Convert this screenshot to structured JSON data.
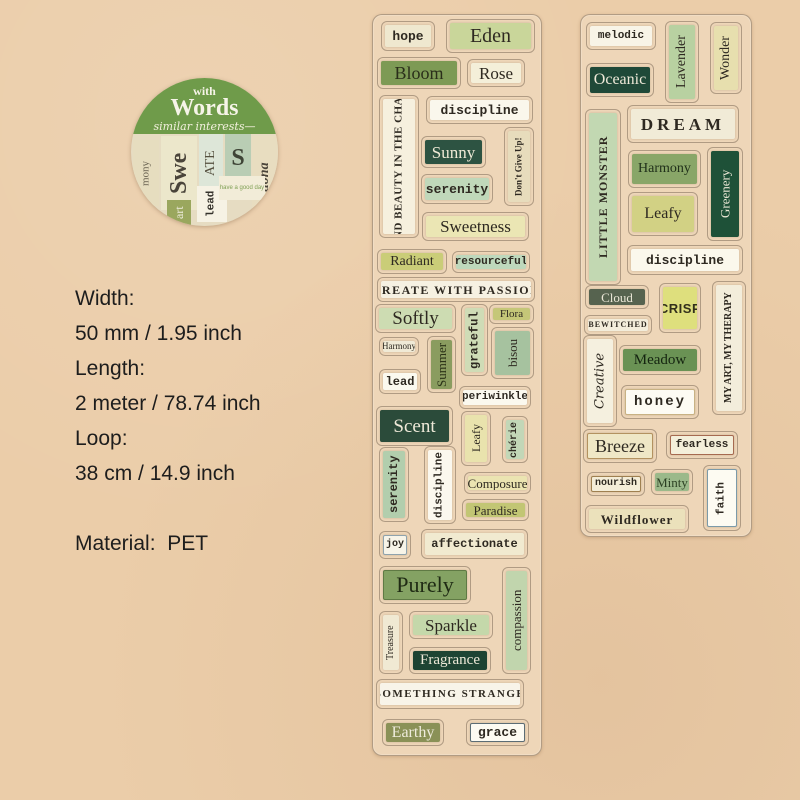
{
  "colors": {
    "page_background": "#ebcda9",
    "strip_background": "#eed6b8",
    "badge_green": "#6f9b4a",
    "ink": "#2e2921"
  },
  "badge": {
    "top_text": "with",
    "title": "Words",
    "subtitle": "similar interests",
    "collage": [
      {
        "t": "mony",
        "x": 2,
        "y": 62,
        "w": 26,
        "h": 66,
        "bg": "#e6ddbf",
        "fg": "#6a6352",
        "f": "serif",
        "s": 11,
        "v": true
      },
      {
        "t": "Swe",
        "x": 30,
        "y": 58,
        "w": 36,
        "h": 74,
        "bg": "#ece7cb",
        "fg": "#4a443a",
        "f": "serif",
        "s": 24,
        "v": true,
        "bold": true
      },
      {
        "t": "ATE",
        "x": 68,
        "y": 56,
        "w": 24,
        "h": 58,
        "bg": "#dde6d8",
        "fg": "#55503f",
        "f": "serif",
        "s": 14,
        "v": true
      },
      {
        "t": "S",
        "x": 94,
        "y": 56,
        "w": 26,
        "h": 48,
        "bg": "#b9cdb4",
        "fg": "#3e4436",
        "f": "serif",
        "s": 24,
        "bold": true
      },
      {
        "t": "tiona",
        "x": 121,
        "y": 58,
        "w": 26,
        "h": 82,
        "bg": "#e8ddc0",
        "fg": "#4a443a",
        "f": "serif",
        "s": 14,
        "v": true,
        "it": true,
        "bold": true
      },
      {
        "t": "lead",
        "x": 66,
        "y": 108,
        "w": 30,
        "h": 36,
        "bg": "#f6f2e4",
        "fg": "#33302a",
        "f": "mono",
        "s": 11,
        "v": true,
        "bold": true
      },
      {
        "t": "art",
        "x": 36,
        "y": 122,
        "w": 24,
        "h": 26,
        "bg": "#9aa75e",
        "fg": "#f0eddf",
        "f": "serif",
        "s": 12,
        "v": true
      },
      {
        "t": "have a good day",
        "x": 88,
        "y": 98,
        "w": 46,
        "h": 24,
        "bg": "#f2ecd8",
        "fg": "#7fa055",
        "f": "sans",
        "s": 6
      }
    ]
  },
  "specs": {
    "lines": [
      "Width:",
      "50 mm / 1.95 inch",
      "Length:",
      "2 meter / 78.74 inch",
      "Loop:",
      "38 cm / 14.9 inch",
      "",
      "Material:  PET"
    ]
  },
  "strips": [
    {
      "name": "left-strip",
      "stickers": [
        {
          "t": "hope",
          "x": 8,
          "y": 6,
          "w": 54,
          "h": 30,
          "bg": "#efe8cf",
          "f": "mono",
          "s": 13,
          "bold": true
        },
        {
          "t": "Eden",
          "x": 73,
          "y": 4,
          "w": 89,
          "h": 34,
          "bg": "#c9d69a",
          "f": "serif",
          "s": 20
        },
        {
          "t": "Bloom",
          "x": 4,
          "y": 42,
          "w": 84,
          "h": 32,
          "bg": "#7d9a55",
          "fg": "#2a2e1a",
          "f": "serif",
          "s": 18
        },
        {
          "t": "Rose",
          "x": 94,
          "y": 44,
          "w": 58,
          "h": 28,
          "bg": "#f4efd9",
          "f": "serif",
          "s": 17
        },
        {
          "t": "discipline",
          "x": 53,
          "y": 81,
          "w": 107,
          "h": 28,
          "bg": "#faf7ec",
          "f": "mono",
          "s": 13,
          "bold": true
        },
        {
          "t": "FIND BEAUTY IN THE CHAOS",
          "x": 6,
          "y": 80,
          "w": 40,
          "h": 143,
          "v": true,
          "bg": "#f6f0de",
          "f": "serif",
          "s": 11,
          "bold": true,
          "sp": 0.5
        },
        {
          "t": "Sunny",
          "x": 48,
          "y": 121,
          "w": 65,
          "h": 32,
          "bg": "#2d5342",
          "fg": "#efead6",
          "f": "serif",
          "s": 17
        },
        {
          "t": "Don't Give Up!",
          "x": 131,
          "y": 112,
          "w": 30,
          "h": 79,
          "v": true,
          "bg": "#e7dcbc",
          "f": "serif",
          "s": 9,
          "bold": true
        },
        {
          "t": "serenity",
          "x": 48,
          "y": 159,
          "w": 72,
          "h": 30,
          "bg": "#c0d8ba",
          "f": "mono",
          "s": 13,
          "bold": true
        },
        {
          "t": "Sweetness",
          "x": 49,
          "y": 197,
          "w": 107,
          "h": 29,
          "bg": "#ebe6b4",
          "f": "serif",
          "s": 17
        },
        {
          "t": "Radiant",
          "x": 4,
          "y": 234,
          "w": 70,
          "h": 25,
          "bg": "#cacd78",
          "f": "serif",
          "s": 14
        },
        {
          "t": "resourceful",
          "x": 79,
          "y": 236,
          "w": 78,
          "h": 22,
          "bg": "#bed8bc",
          "f": "mono",
          "s": 11,
          "bold": true
        },
        {
          "t": "CREATE WITH PASSION",
          "x": 4,
          "y": 262,
          "w": 158,
          "h": 25,
          "bg": "#f6f1e2",
          "f": "serif",
          "s": 12,
          "bold": true,
          "sp": 1.5
        },
        {
          "t": "Softly",
          "x": 2,
          "y": 289,
          "w": 81,
          "h": 29,
          "bg": "#cddcb2",
          "f": "serif",
          "s": 19
        },
        {
          "t": "Flora",
          "x": 116,
          "y": 289,
          "w": 45,
          "h": 20,
          "bg": "#c5c778",
          "f": "serif",
          "s": 11
        },
        {
          "t": "grateful",
          "x": 88,
          "y": 289,
          "w": 27,
          "h": 72,
          "v": true,
          "bg": "#cfdcb6",
          "f": "mono",
          "s": 12,
          "bold": true
        },
        {
          "t": "Harmony",
          "x": 6,
          "y": 322,
          "w": 40,
          "h": 19,
          "bg": "#f0ead6",
          "f": "serif",
          "s": 9
        },
        {
          "t": "bisou",
          "x": 118,
          "y": 312,
          "w": 43,
          "h": 52,
          "v": true,
          "bg": "#a6c29f",
          "f": "serif",
          "s": 13
        },
        {
          "t": "Summer",
          "x": 54,
          "y": 321,
          "w": 29,
          "h": 57,
          "v": true,
          "bg": "#8a9c5f",
          "fg": "#2c3318",
          "f": "serif",
          "s": 13
        },
        {
          "t": "lead",
          "x": 6,
          "y": 354,
          "w": 42,
          "h": 25,
          "bg": "#fbf9ef",
          "f": "mono",
          "s": 12,
          "bold": true
        },
        {
          "t": "periwinkle",
          "x": 86,
          "y": 371,
          "w": 72,
          "h": 23,
          "bg": "#fbf9ef",
          "f": "mono",
          "s": 11,
          "bold": true
        },
        {
          "t": "Scent",
          "x": 3,
          "y": 391,
          "w": 77,
          "h": 40,
          "bg": "#2b4b3a",
          "fg": "#eee9d8",
          "f": "serif",
          "s": 19
        },
        {
          "t": "Leafy",
          "x": 88,
          "y": 396,
          "w": 30,
          "h": 55,
          "v": true,
          "bg": "#e9e3ad",
          "f": "serif",
          "s": 12
        },
        {
          "t": "chérie",
          "x": 129,
          "y": 401,
          "w": 26,
          "h": 47,
          "v": true,
          "bg": "#c2d7b7",
          "f": "mono",
          "s": 10,
          "bold": true
        },
        {
          "t": "serenity",
          "x": 6,
          "y": 432,
          "w": 30,
          "h": 75,
          "v": true,
          "bg": "#b2cead",
          "f": "mono",
          "s": 12,
          "bold": true
        },
        {
          "t": "discipline",
          "x": 51,
          "y": 431,
          "w": 32,
          "h": 78,
          "v": true,
          "bg": "#fbf8ee",
          "f": "mono",
          "s": 11,
          "bold": true
        },
        {
          "t": "Composure",
          "x": 91,
          "y": 457,
          "w": 67,
          "h": 22,
          "bg": "#ebe4b1",
          "f": "serif",
          "s": 13
        },
        {
          "t": "Paradise",
          "x": 89,
          "y": 484,
          "w": 67,
          "h": 22,
          "bg": "#c2c674",
          "f": "serif",
          "s": 13
        },
        {
          "t": "joy",
          "x": 6,
          "y": 516,
          "w": 32,
          "h": 28,
          "bg": "#f7f4e8",
          "f": "mono",
          "s": 10,
          "bold": true,
          "b": "#8fa3ad"
        },
        {
          "t": "affectionate",
          "x": 48,
          "y": 514,
          "w": 107,
          "h": 30,
          "bg": "#f1ead0",
          "f": "mono",
          "s": 12,
          "bold": true
        },
        {
          "t": "Purely",
          "x": 6,
          "y": 551,
          "w": 92,
          "h": 38,
          "bg": "#84a263",
          "fg": "#1f2b14",
          "f": "serif",
          "s": 22,
          "b": "#5f7a44"
        },
        {
          "t": "compassion",
          "x": 129,
          "y": 552,
          "w": 29,
          "h": 107,
          "v": true,
          "bg": "#c1d5ad",
          "f": "serif",
          "s": 13
        },
        {
          "t": "Treasure",
          "x": 6,
          "y": 596,
          "w": 24,
          "h": 63,
          "v": true,
          "bg": "#f0e9d3",
          "f": "serif",
          "s": 10
        },
        {
          "t": "Sparkle",
          "x": 36,
          "y": 596,
          "w": 84,
          "h": 28,
          "bg": "#c4d8aa",
          "f": "serif",
          "s": 17
        },
        {
          "t": "Fragrance",
          "x": 36,
          "y": 632,
          "w": 82,
          "h": 27,
          "bg": "#1e4433",
          "fg": "#eee9d8",
          "f": "serif",
          "s": 15
        },
        {
          "t": "SOMETHING STRANGE",
          "x": 3,
          "y": 664,
          "w": 148,
          "h": 30,
          "bg": "#f8f4e9",
          "f": "serif",
          "s": 11,
          "bold": true,
          "sp": 1.5
        },
        {
          "t": "Earthy",
          "x": 9,
          "y": 704,
          "w": 62,
          "h": 27,
          "bg": "#8a9157",
          "fg": "#efecdd",
          "f": "serif",
          "s": 16
        },
        {
          "t": "grace",
          "x": 93,
          "y": 704,
          "w": 63,
          "h": 27,
          "bg": "#fdfbf2",
          "f": "mono",
          "s": 13,
          "bold": true,
          "b": "#5c6d75"
        }
      ]
    },
    {
      "name": "right-strip",
      "stickers": [
        {
          "t": "melodic",
          "x": 5,
          "y": 7,
          "w": 70,
          "h": 28,
          "bg": "#f8f4e7",
          "f": "mono",
          "s": 11,
          "bold": true
        },
        {
          "t": "Lavender",
          "x": 84,
          "y": 6,
          "w": 34,
          "h": 82,
          "v": true,
          "bg": "#b8d1a1",
          "f": "serif",
          "s": 14
        },
        {
          "t": "Wonder",
          "x": 129,
          "y": 7,
          "w": 32,
          "h": 72,
          "v": true,
          "bg": "#e7dfae",
          "f": "serif",
          "s": 14
        },
        {
          "t": "Oceanic",
          "x": 5,
          "y": 48,
          "w": 68,
          "h": 34,
          "bg": "#1f4938",
          "fg": "#eee9d8",
          "f": "serif",
          "s": 16
        },
        {
          "t": "LITTLE MONSTER",
          "x": 4,
          "y": 94,
          "w": 36,
          "h": 176,
          "v": true,
          "bg": "#c2d8b2",
          "f": "serif",
          "s": 12,
          "bold": true,
          "sp": 1
        },
        {
          "t": "DREAM",
          "x": 46,
          "y": 90,
          "w": 112,
          "h": 38,
          "bg": "#f1ebd7",
          "f": "serif",
          "s": 17,
          "bold": true,
          "sp": 4
        },
        {
          "t": "Harmony",
          "x": 47,
          "y": 135,
          "w": 73,
          "h": 38,
          "bg": "#89a668",
          "fg": "#20301a",
          "f": "serif",
          "s": 14
        },
        {
          "t": "Greenery",
          "x": 126,
          "y": 132,
          "w": 36,
          "h": 94,
          "v": true,
          "bg": "#1e5138",
          "fg": "#e9e6d4",
          "f": "serif",
          "s": 13
        },
        {
          "t": "Leafy",
          "x": 47,
          "y": 177,
          "w": 70,
          "h": 44,
          "bg": "#d2d184",
          "f": "serif",
          "s": 16
        },
        {
          "t": "discipline",
          "x": 46,
          "y": 230,
          "w": 116,
          "h": 30,
          "bg": "#fbf8ec",
          "f": "mono",
          "s": 13,
          "bold": true
        },
        {
          "t": "Cloud",
          "x": 4,
          "y": 270,
          "w": 64,
          "h": 24,
          "bg": "#56634f",
          "fg": "#e9e6d6",
          "f": "serif",
          "s": 13
        },
        {
          "t": "CRISP",
          "x": 78,
          "y": 268,
          "w": 42,
          "h": 50,
          "bg": "#dedf7d",
          "fg": "#33301c",
          "f": "sans",
          "s": 13,
          "bold": true,
          "sp": 0.5
        },
        {
          "t": "MY ART, MY THERAPY",
          "x": 131,
          "y": 266,
          "w": 34,
          "h": 134,
          "v": true,
          "bg": "#f3eddb",
          "f": "serif",
          "s": 10,
          "bold": true
        },
        {
          "t": "BEWITCHED",
          "x": 3,
          "y": 300,
          "w": 68,
          "h": 20,
          "bg": "#f3eddb",
          "f": "serif",
          "s": 8,
          "bold": true,
          "sp": 1
        },
        {
          "t": "Creative",
          "x": 2,
          "y": 320,
          "w": 34,
          "h": 92,
          "v": true,
          "bg": "#f5f0df",
          "f": "script",
          "s": 13,
          "it": true
        },
        {
          "t": "Meadow",
          "x": 38,
          "y": 330,
          "w": 82,
          "h": 30,
          "bg": "#6a9254",
          "fg": "#142410",
          "f": "serif",
          "s": 15
        },
        {
          "t": "honey",
          "x": 40,
          "y": 370,
          "w": 78,
          "h": 34,
          "bg": "#fdfbf3",
          "f": "mono",
          "s": 14,
          "bold": true,
          "sp": 2,
          "b": "#c8b283"
        },
        {
          "t": "Breeze",
          "x": 2,
          "y": 414,
          "w": 74,
          "h": 34,
          "bg": "#efe7c6",
          "f": "serif",
          "s": 18,
          "b": "#b39260"
        },
        {
          "t": "fearless",
          "x": 85,
          "y": 416,
          "w": 72,
          "h": 28,
          "bg": "#f4efda",
          "f": "mono",
          "s": 11,
          "bold": true,
          "b": "#a66a50"
        },
        {
          "t": "nourish",
          "x": 6,
          "y": 457,
          "w": 58,
          "h": 24,
          "bg": "#f4edd7",
          "f": "mono",
          "s": 10,
          "bold": true,
          "b": "#9f8050"
        },
        {
          "t": "Minty",
          "x": 70,
          "y": 454,
          "w": 42,
          "h": 26,
          "bg": "#9bb98a",
          "fg": "#2c4023",
          "f": "serif",
          "s": 13
        },
        {
          "t": "faith",
          "x": 122,
          "y": 450,
          "w": 38,
          "h": 66,
          "v": true,
          "bg": "#fdfbf2",
          "f": "mono",
          "s": 11,
          "bold": true,
          "b": "#7b9aa9"
        },
        {
          "t": "Wildflower",
          "x": 4,
          "y": 490,
          "w": 104,
          "h": 28,
          "bg": "#ebe1bb",
          "f": "serif",
          "s": 13,
          "bold": true,
          "sp": 1
        }
      ]
    }
  ]
}
